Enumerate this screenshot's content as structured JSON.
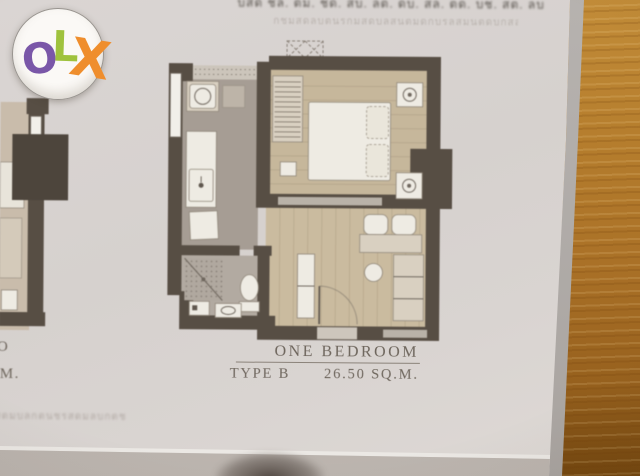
{
  "watermark": {
    "letters": [
      {
        "char": "O",
        "color": "#7a57a8"
      },
      {
        "char": "L",
        "color": "#9fc23d"
      },
      {
        "char": "X",
        "color": "#ef8e2d"
      }
    ]
  },
  "header": {
    "top_cropped_illegible": "บสด ชล. ตม. ชด. สบ. ลต. ดบ. สล. ตด. บช. สต. ลบ",
    "thai_caption_illegible": "กชมสดลบตนรกมสดบลสนตมดกบรลสมนตดบกสลมนรด"
  },
  "plan_label": {
    "name": "ONE BEDROOM",
    "type": "TYPE B",
    "area": "26.50 SQ.M."
  },
  "adjacent_plan_fragment": {
    "name_fragment": "IO",
    "area_fragment": "M."
  },
  "footer": {
    "thai_note_fragment_illegible": "สดมบลกตนชรสดมลบกตช"
  },
  "palette": {
    "wall": "#574e44",
    "wallDark": "#4d453c",
    "floorGray": "#a69d94",
    "bathGray": "#b2aaa1",
    "woodFloor": "#c6b79b",
    "furnWhite": "#eeebe3",
    "furnBeige": "#d9d0c1",
    "textMain": "#6e665d",
    "olxO": "#7a57a8",
    "olxL": "#9fc23d",
    "olxX": "#ef8e2d",
    "woodTable": "#b57d2d",
    "paper": "#d8d3d0"
  }
}
